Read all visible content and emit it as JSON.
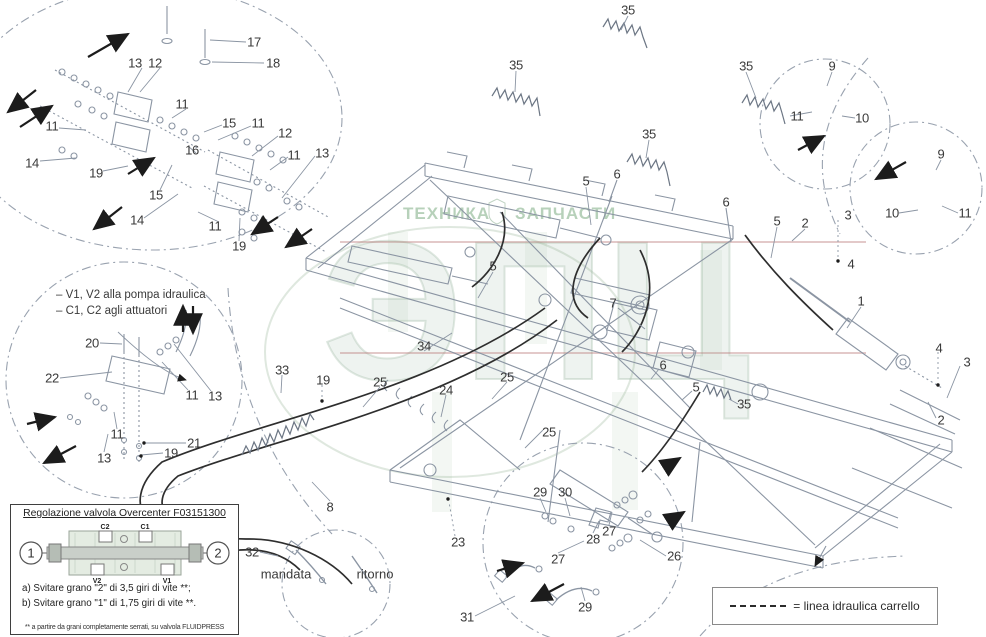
{
  "watermark": {
    "brand_left": "ТЕХНИКА",
    "brand_right": "ЗАПЧАСТИ",
    "big_text": "ЭПЦ"
  },
  "notes": {
    "line1": "– V1, V2 alla pompa idraulica",
    "line2": "– C1, C2 agli attuatori"
  },
  "flow_labels": {
    "supply": "mandata",
    "return": "ritorno"
  },
  "overcenter_box": {
    "title": "Regolazione valvola Overcenter F03151300",
    "balloon_left": "1",
    "balloon_right": "2",
    "ports": {
      "top_left": "C2",
      "top_right": "C1",
      "bottom_left": "V2",
      "bottom_right": "V1"
    },
    "step_a": "a) Svitare grano \"2\" di 3,5 giri di vite **;",
    "step_b": "b) Svitare grano \"1\" di 1,75 giri di vite **.",
    "footnote": "** a partire da grani completamente serrati, su valvola FLUIDPRESS"
  },
  "legend": {
    "label": "= linea idraulica carrello"
  },
  "callouts": [
    {
      "n": "17",
      "x": 254,
      "y": 42
    },
    {
      "n": "18",
      "x": 273,
      "y": 63
    },
    {
      "n": "13",
      "x": 135,
      "y": 63
    },
    {
      "n": "12",
      "x": 155,
      "y": 63
    },
    {
      "n": "11",
      "x": 182,
      "y": 104
    },
    {
      "n": "15",
      "x": 229,
      "y": 123
    },
    {
      "n": "11",
      "x": 258,
      "y": 123
    },
    {
      "n": "12",
      "x": 285,
      "y": 133
    },
    {
      "n": "16",
      "x": 192,
      "y": 150
    },
    {
      "n": "11",
      "x": 52,
      "y": 126
    },
    {
      "n": "14",
      "x": 32,
      "y": 163
    },
    {
      "n": "19",
      "x": 96,
      "y": 173
    },
    {
      "n": "15",
      "x": 156,
      "y": 195
    },
    {
      "n": "11",
      "x": 294,
      "y": 155
    },
    {
      "n": "13",
      "x": 322,
      "y": 153
    },
    {
      "n": "14",
      "x": 137,
      "y": 220
    },
    {
      "n": "11",
      "x": 215,
      "y": 226
    },
    {
      "n": "19",
      "x": 239,
      "y": 246
    },
    {
      "n": "20",
      "x": 92,
      "y": 343
    },
    {
      "n": "22",
      "x": 52,
      "y": 378
    },
    {
      "n": "11",
      "x": 192,
      "y": 395
    },
    {
      "n": "13",
      "x": 215,
      "y": 396
    },
    {
      "n": "21",
      "x": 194,
      "y": 443
    },
    {
      "n": "19",
      "x": 171,
      "y": 453
    },
    {
      "n": "11",
      "x": 117,
      "y": 434
    },
    {
      "n": "13",
      "x": 104,
      "y": 458
    },
    {
      "n": "35",
      "x": 628,
      "y": 10
    },
    {
      "n": "35",
      "x": 516,
      "y": 65
    },
    {
      "n": "35",
      "x": 746,
      "y": 66
    },
    {
      "n": "35",
      "x": 649,
      "y": 134
    },
    {
      "n": "9",
      "x": 832,
      "y": 66
    },
    {
      "n": "11",
      "x": 797,
      "y": 116
    },
    {
      "n": "10",
      "x": 862,
      "y": 118
    },
    {
      "n": "9",
      "x": 941,
      "y": 154
    },
    {
      "n": "10",
      "x": 892,
      "y": 213
    },
    {
      "n": "11",
      "x": 965,
      "y": 213
    },
    {
      "n": "6",
      "x": 617,
      "y": 174
    },
    {
      "n": "5",
      "x": 586,
      "y": 181
    },
    {
      "n": "6",
      "x": 726,
      "y": 202
    },
    {
      "n": "5",
      "x": 777,
      "y": 221
    },
    {
      "n": "2",
      "x": 805,
      "y": 223
    },
    {
      "n": "3",
      "x": 848,
      "y": 215
    },
    {
      "n": "4",
      "x": 851,
      "y": 264
    },
    {
      "n": "1",
      "x": 861,
      "y": 301
    },
    {
      "n": "7",
      "x": 613,
      "y": 303
    },
    {
      "n": "5",
      "x": 493,
      "y": 266
    },
    {
      "n": "34",
      "x": 424,
      "y": 346
    },
    {
      "n": "33",
      "x": 282,
      "y": 370
    },
    {
      "n": "19",
      "x": 323,
      "y": 380
    },
    {
      "n": "25",
      "x": 380,
      "y": 382
    },
    {
      "n": "24",
      "x": 446,
      "y": 390
    },
    {
      "n": "25",
      "x": 507,
      "y": 377
    },
    {
      "n": "25",
      "x": 549,
      "y": 432
    },
    {
      "n": "6",
      "x": 663,
      "y": 365
    },
    {
      "n": "5",
      "x": 696,
      "y": 387
    },
    {
      "n": "35",
      "x": 744,
      "y": 404
    },
    {
      "n": "4",
      "x": 939,
      "y": 348
    },
    {
      "n": "3",
      "x": 967,
      "y": 362
    },
    {
      "n": "2",
      "x": 941,
      "y": 420
    },
    {
      "n": "8",
      "x": 330,
      "y": 507
    },
    {
      "n": "32",
      "x": 252,
      "y": 552
    },
    {
      "n": "23",
      "x": 458,
      "y": 542
    },
    {
      "n": "31",
      "x": 467,
      "y": 617
    },
    {
      "n": "29",
      "x": 540,
      "y": 492
    },
    {
      "n": "30",
      "x": 565,
      "y": 492
    },
    {
      "n": "27",
      "x": 609,
      "y": 531
    },
    {
      "n": "28",
      "x": 593,
      "y": 539
    },
    {
      "n": "27",
      "x": 558,
      "y": 559
    },
    {
      "n": "26",
      "x": 674,
      "y": 556
    },
    {
      "n": "29",
      "x": 585,
      "y": 607
    }
  ]
}
